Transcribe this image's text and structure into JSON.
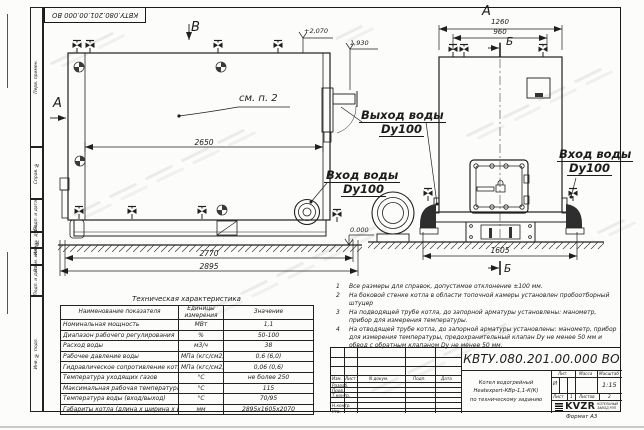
{
  "stamp_top": "КВТУ.080.201.00.000  ВО",
  "margin_labels": [
    "Перв. примен.",
    "Справ. №",
    "Подп. и дата",
    "Инв. № дубл.",
    "Взам. инв. №",
    "Подп. и дата",
    "Инв. № подл."
  ],
  "front_view": {
    "view_label": "В",
    "arrow_label": "А",
    "callout": "см. п. 2",
    "dim_body": "2650",
    "dim_base": "2770",
    "dim_overall": "2895",
    "elev_top": "+2,070",
    "elev_mid": "1,930",
    "elev_zero": "0.000",
    "outlet_line1": "Выход воды",
    "outlet_line2": "Dy100",
    "inlet_line1": "Вход воды",
    "inlet_line2": "Dy100"
  },
  "side_view": {
    "view_label": "А",
    "section_label_top": "Б",
    "section_label_bottom": "Б",
    "dim_top": "1260",
    "dim_top2": "960",
    "dim_base": "1605",
    "inlet_line1": "Вход воды",
    "inlet_line2": "Dy100"
  },
  "notes": [
    {
      "n": "1",
      "text": "Все размеры для справок, допустимое отклонение ±100 мм."
    },
    {
      "n": "2",
      "text": "На боковой стенке котла в области топочной камеры установлен пробоотборный штуцер"
    },
    {
      "n": "3",
      "text": "На подводящей трубе котла, до запорной арматуры установлены: манометр, прибор для измерения температуры."
    },
    {
      "n": "4",
      "text": "На отводящей трубе котла, до запорной арматуры установлены: манометр, прибор для измерения температуры, предохранительный клапан Dy не менее 50 мм и обвод с обратным клапаном Dy не менее 50 мм."
    }
  ],
  "tech_table": {
    "title": "Техническая характеристика",
    "headers": [
      "Наименование показателя",
      "Единицы измерения",
      "Значение"
    ],
    "rows": [
      [
        "Номинальная мощность",
        "МВт",
        "1,1"
      ],
      [
        "Диапазон рабочего регулирования",
        "%",
        "50-100"
      ],
      [
        "Расход воды",
        "м3/ч",
        "38"
      ],
      [
        "Рабочее давление воды",
        "МПа (кгс/см2)",
        "0,6 (6,0)"
      ],
      [
        "Гидравлическое сопротивление котла",
        "МПа (кгс/см2)",
        "0,06 (0,6)"
      ],
      [
        "Температура уходящих газов",
        "°С",
        "не более 250"
      ],
      [
        "Максимальная рабочая температура воды",
        "°С",
        "115"
      ],
      [
        "Температура воды (вход/выход)",
        "°С",
        "70/95"
      ],
      [
        "Габариты котла (длина х ширина х высота)",
        "мм",
        "2895х1605х2070"
      ]
    ]
  },
  "title_block": {
    "designation": "КВТУ.080.201.00.000  ВО",
    "doc_name_line1": "Котел водогрейный",
    "doc_name_line2": "Heatexpert-КВр-1,1-К(К)",
    "doc_name_line3": "по техническому заданию",
    "header_cells": [
      "Изм.",
      "Лист",
      "N докум.",
      "Подп.",
      "Дата"
    ],
    "roles": [
      "Разраб.",
      "Пров.",
      "Т.контр.",
      "",
      "Н.контр.",
      "Утв."
    ],
    "lit_label": "Лит.",
    "mass_label": "Масса",
    "scale_label": "Масштаб",
    "lit_value": "И",
    "scale_value": "1:15",
    "sheet_label": "Лист",
    "sheet_value": "1",
    "sheets_label": "Листов",
    "sheets_value": "2",
    "logo_text": "KVZR",
    "company_line1": "КОТЕЛЬНЫЙ",
    "company_line2": "ЗАВОД РЭП",
    "format_label": "Формат  А3"
  }
}
